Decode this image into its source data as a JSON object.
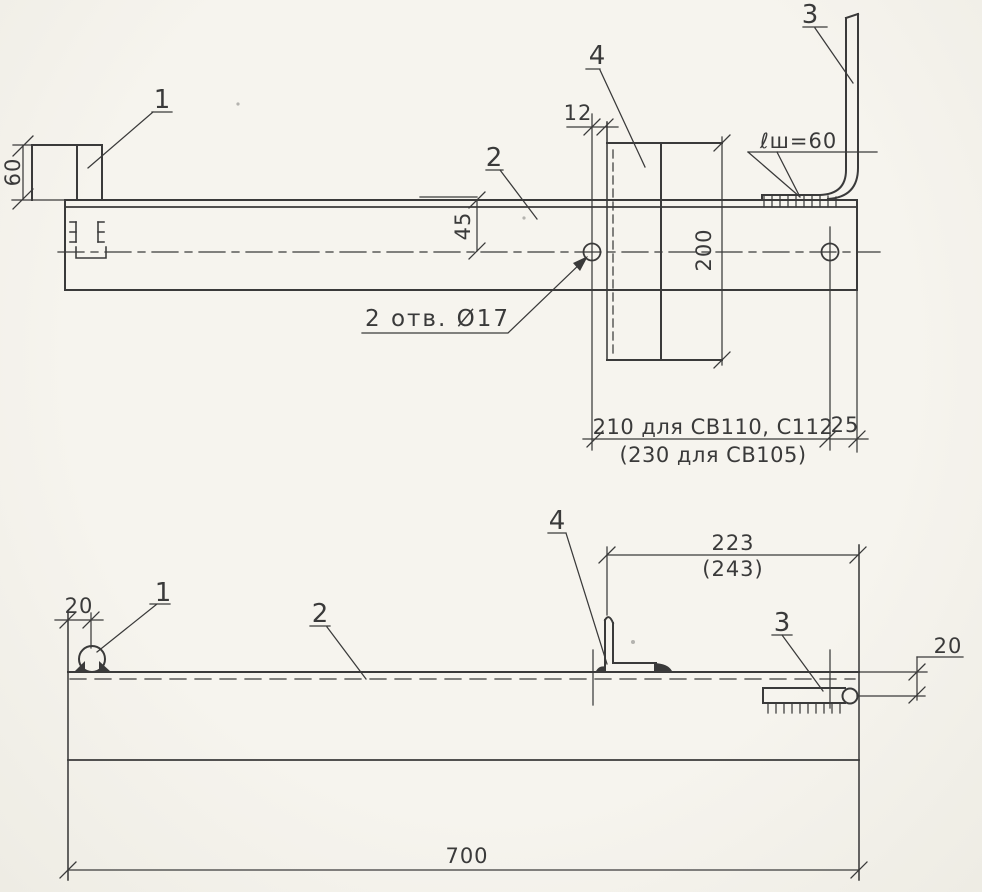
{
  "colors": {
    "paper": "#f4f2ec",
    "ink": "#3a3a3a"
  },
  "top_view": {
    "part_labels": {
      "p1": "1",
      "p2": "2",
      "p3": "3",
      "p4": "4"
    },
    "dim_60": "60",
    "dim_45": "45",
    "dim_12": "12",
    "dim_200": "200",
    "dim_25": "25",
    "dim_210": "210 для СВ110, С112",
    "dim_230": "(230 для СВ105)",
    "holes_note": "2 отв. Ø17",
    "weld_note": "ℓш=60"
  },
  "bottom_view": {
    "part_labels": {
      "p1": "1",
      "p2": "2",
      "p3": "3",
      "p4": "4"
    },
    "dim_20_left": "20",
    "dim_223": "223",
    "dim_243": "(243)",
    "dim_20_right": "20",
    "dim_700": "700"
  }
}
